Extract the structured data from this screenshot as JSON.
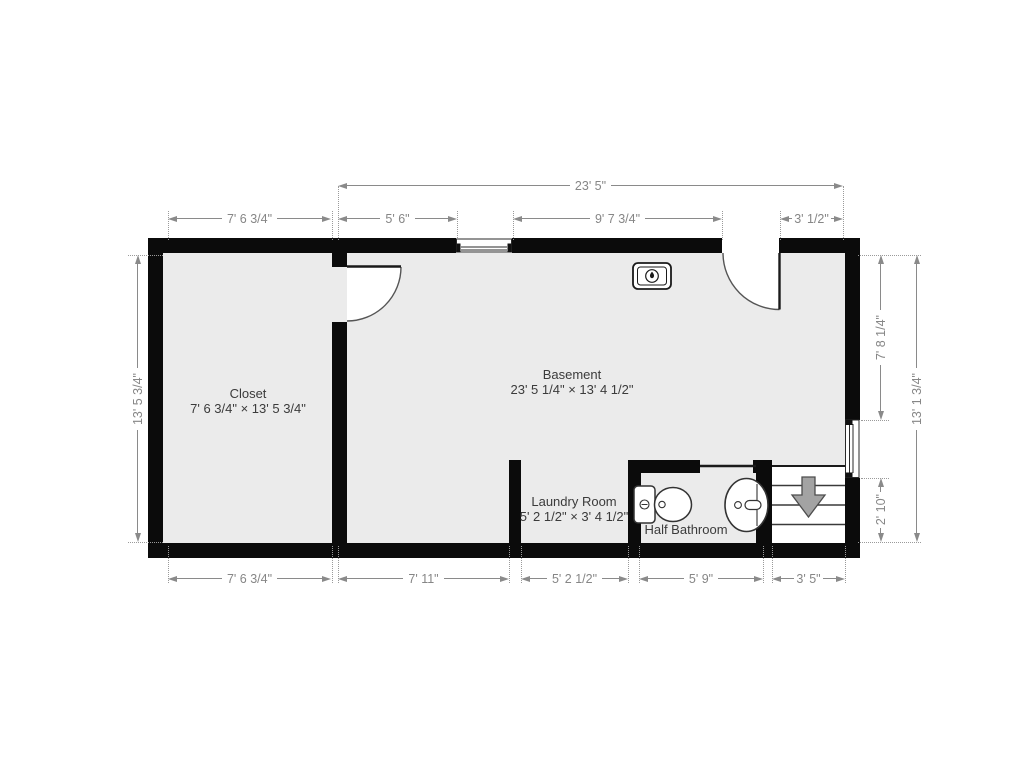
{
  "title": "Basement floor plan",
  "colors": {
    "wall": "#0b0b0b",
    "floor": "#ebebeb",
    "dimension": "#868686",
    "room_label": "#3b3b3b",
    "stairs_arrow": "#a3a3a3"
  },
  "rooms": {
    "closet": {
      "name": "Closet",
      "size": "7' 6 3/4\" × 13' 5 3/4\""
    },
    "basement": {
      "name": "Basement",
      "size": "23' 5 1/4\" × 13' 4 1/2\""
    },
    "laundry": {
      "name": "Laundry Room",
      "size": "5' 2 1/2\" × 3' 4 1/2\""
    },
    "half_bathroom": {
      "name": "Half Bathroom"
    }
  },
  "dimensions": {
    "top_overall": "23' 5\"",
    "top": [
      "7' 6 3/4\"",
      "5' 6\"",
      "9' 7 3/4\"",
      "3' 1/2\""
    ],
    "bottom": [
      "7' 6 3/4\"",
      "7' 11\"",
      "5' 2 1/2\"",
      "5' 9\"",
      "3' 5\""
    ],
    "left": "13' 5 3/4\"",
    "right_top": "7' 8 1/4\"",
    "right_bottom": "2' 10\"",
    "right_overall": "13' 1 3/4\""
  },
  "icons": {
    "furnace": "furnace-icon",
    "stairs_arrow": "stairs-down-arrow-icon",
    "toilet": "toilet-icon",
    "sink": "sink-icon"
  }
}
